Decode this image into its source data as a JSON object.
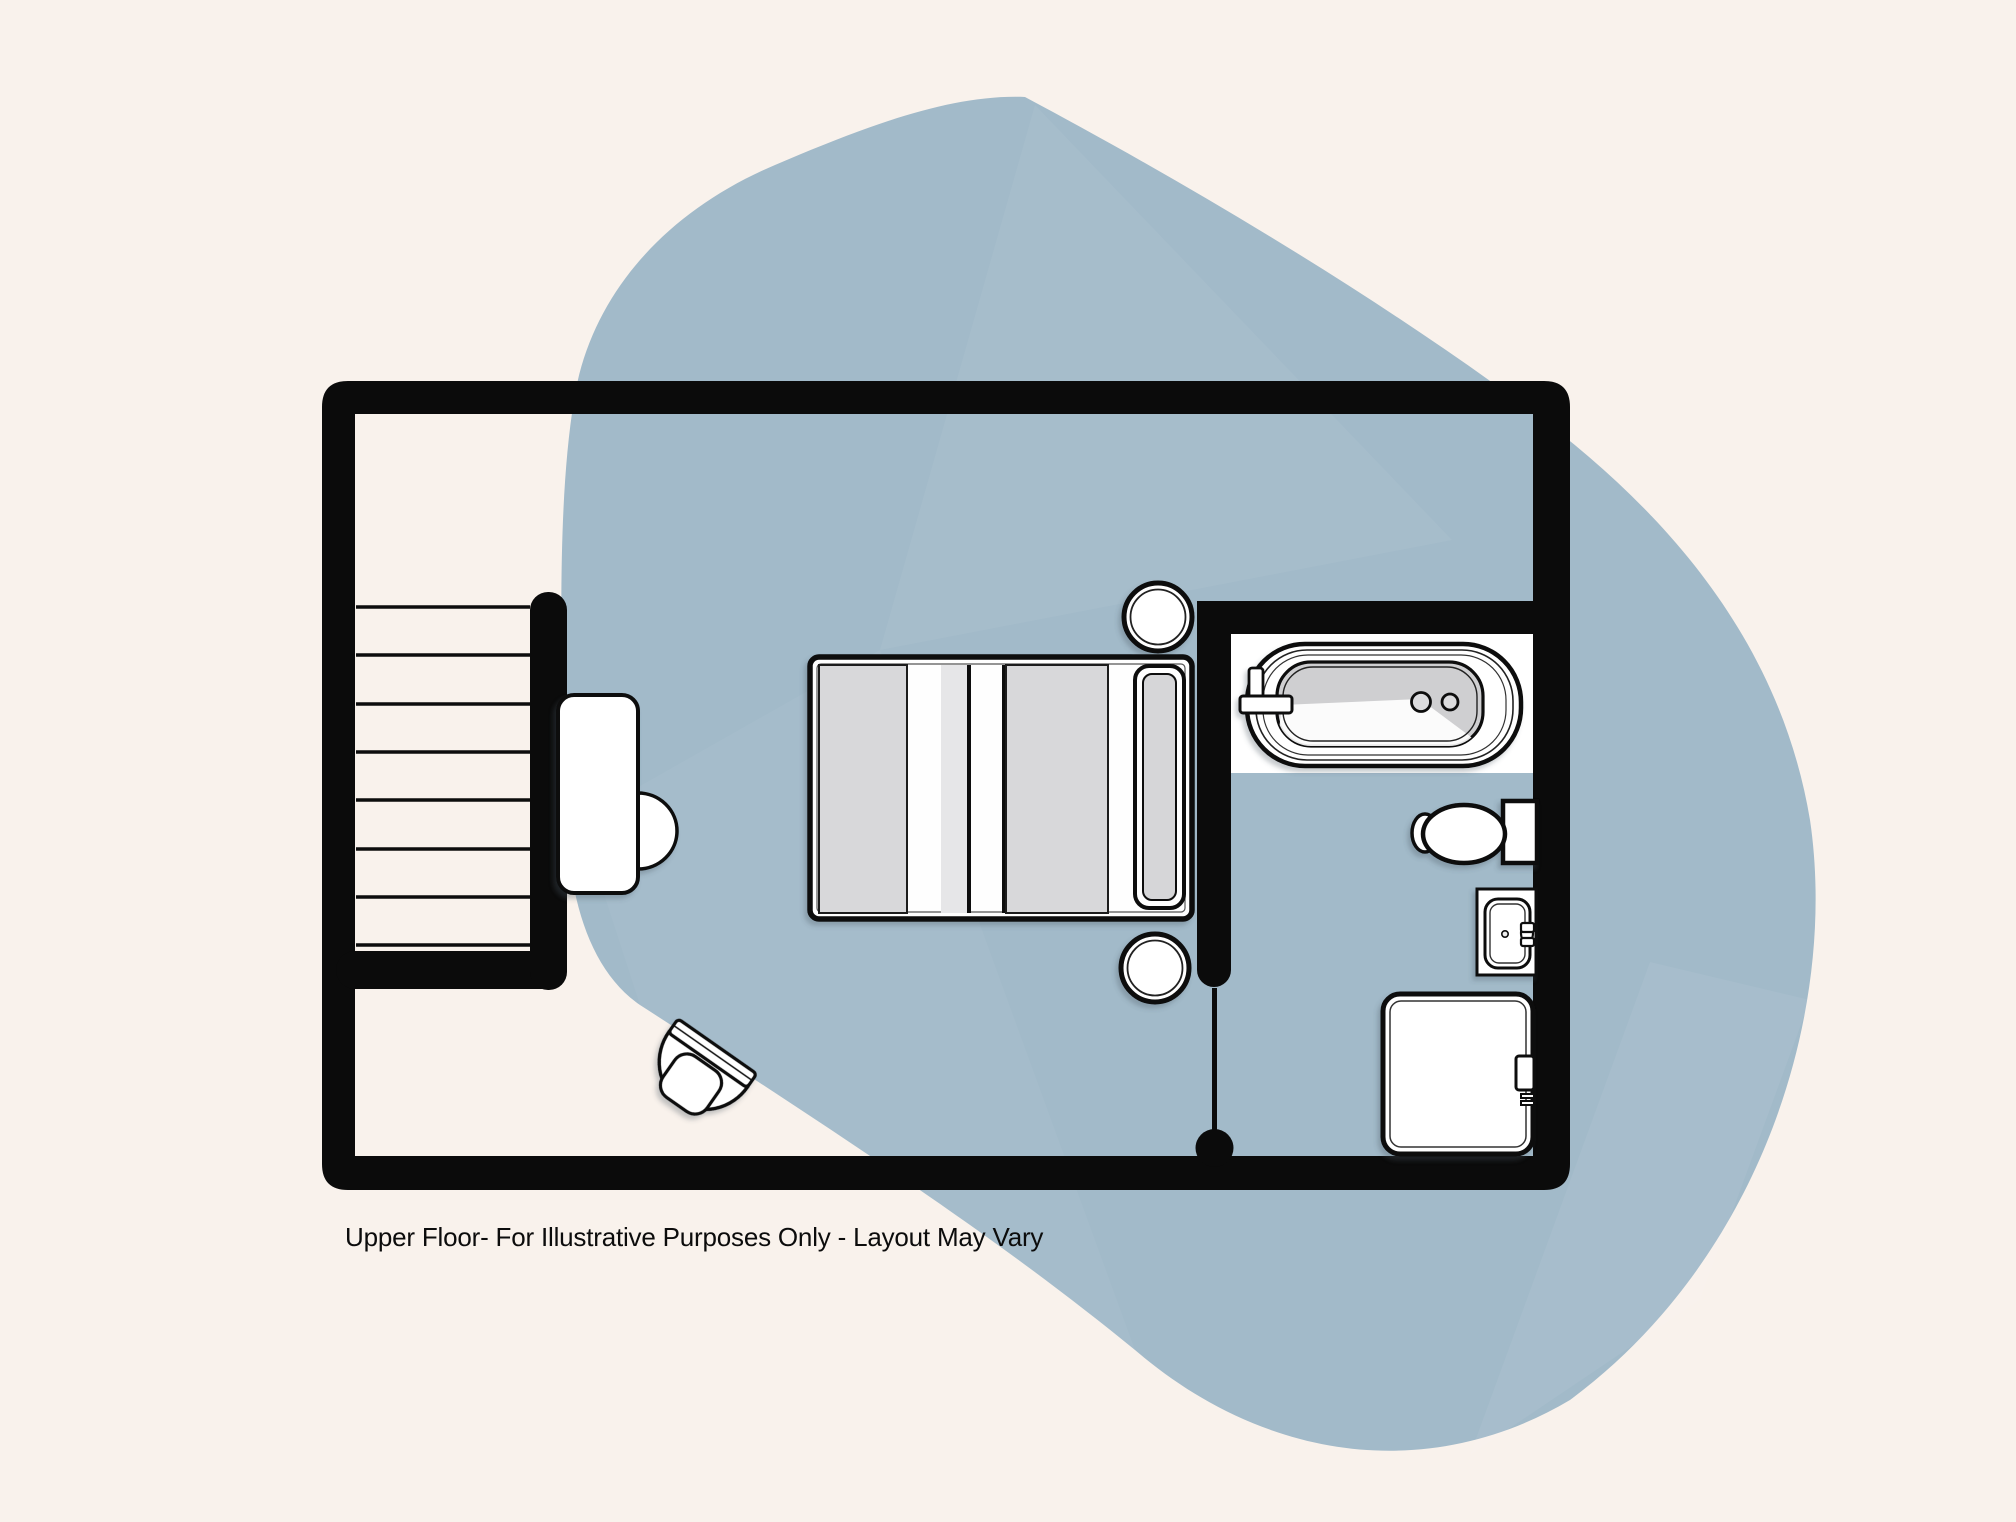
{
  "caption": {
    "text": "Upper Floor- For Illustrative Purposes Only - Layout May Vary"
  },
  "colors": {
    "page_background": "#f9f2ec",
    "blob_fill": "#a2bac9",
    "wall_black": "#0b0b0b",
    "fixture_white": "#ffffff",
    "bed_gray": "#d8d8da",
    "tub_gray": "#cfcfd1",
    "caption_color": "#0c0c0c"
  },
  "plan": {
    "floor_name": "Upper Floor",
    "elements": [
      "staircase",
      "desk",
      "desk-chair",
      "double-bed",
      "nightstand-top",
      "nightstand-bottom",
      "armchair",
      "bathtub",
      "toilet",
      "sink",
      "shower",
      "bathroom-door"
    ]
  }
}
